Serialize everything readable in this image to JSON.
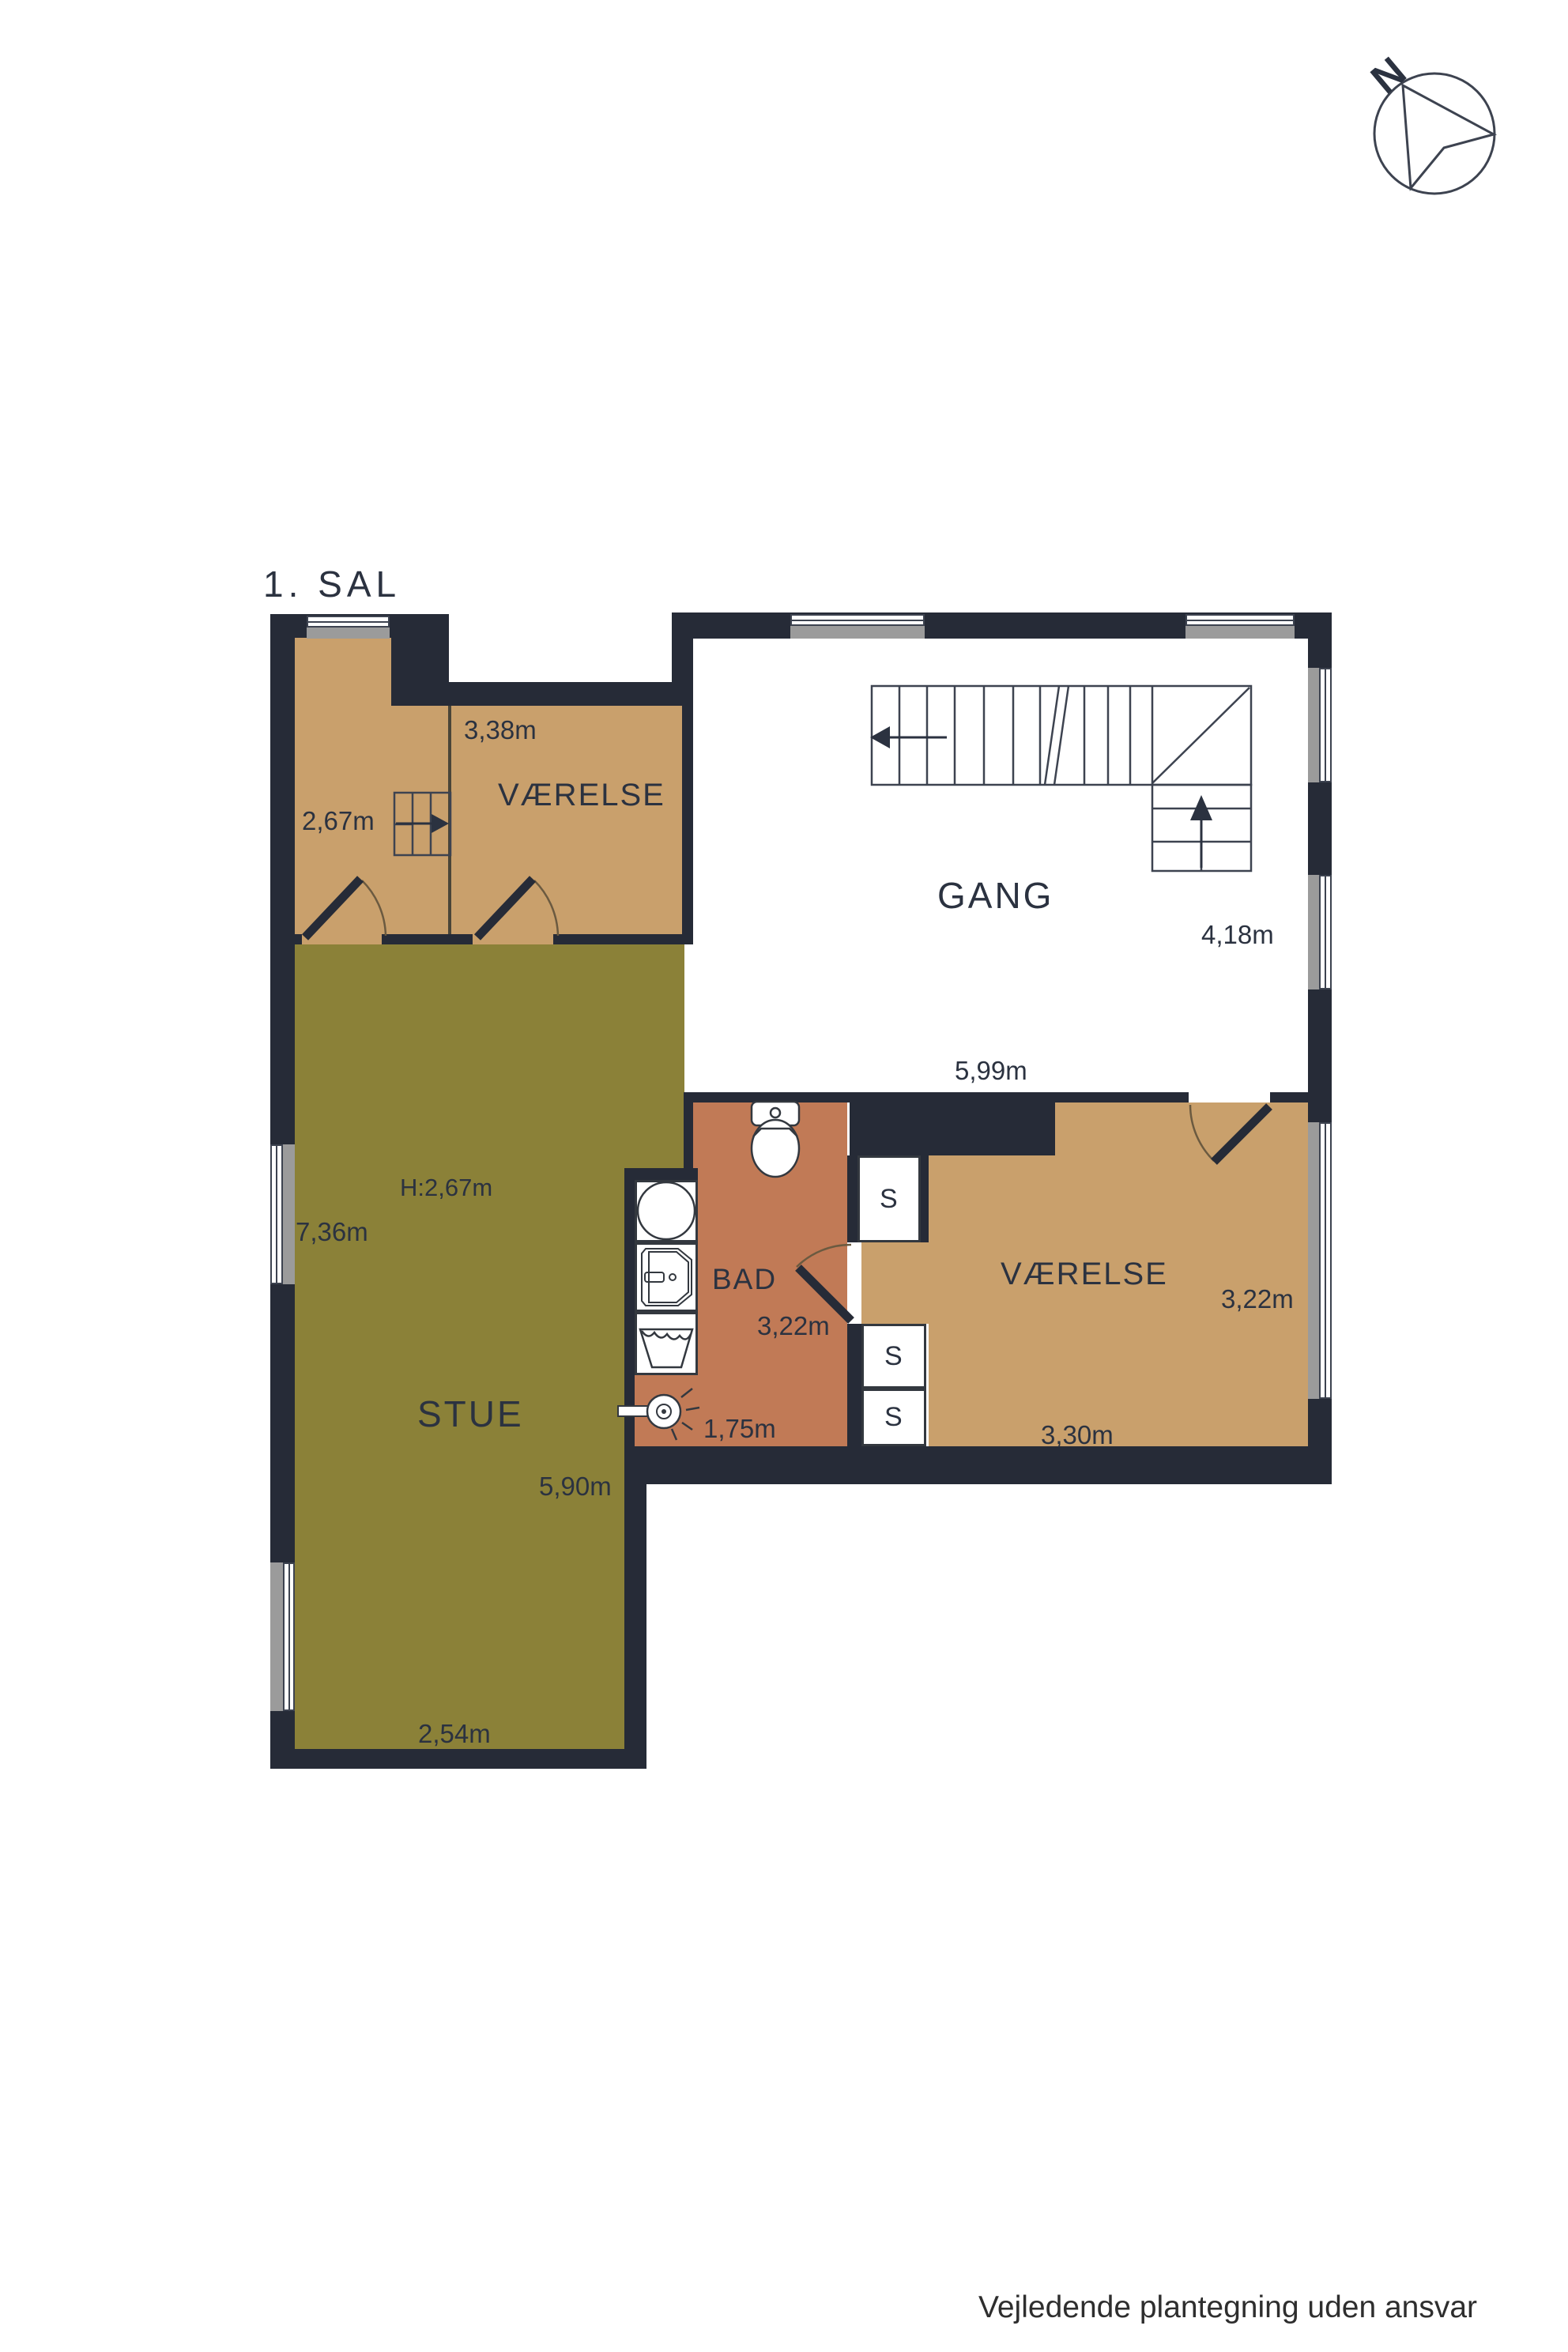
{
  "title": "1. SAL",
  "compass": {
    "label": "N"
  },
  "rooms": {
    "landing": {
      "width_label": "2,67m"
    },
    "vaerelse_top": {
      "name": "VÆRELSE",
      "width_label": "3,38m"
    },
    "gang": {
      "name": "GANG",
      "width_label": "5,99m",
      "depth_label": "4,18m"
    },
    "stue": {
      "name": "STUE",
      "ceiling_label": "H:2,67m",
      "depth_label": "7,36m",
      "width_label": "5,90m",
      "bottom_width_label": "2,54m"
    },
    "bad": {
      "name": "BAD",
      "width_label": "1,75m",
      "depth_label": "3,22m"
    },
    "vaerelse_bottom": {
      "name": "VÆRELSE",
      "width_label": "3,30m",
      "depth_label": "3,22m"
    },
    "closet_label": "S"
  },
  "footer": {
    "disclaimer": "Vejledende plantegning uden ansvar"
  },
  "colors": {
    "wall": "#262b37",
    "room_tan": "#c9a06c",
    "room_olive": "#8b8138",
    "room_bathroom": "#c17a56",
    "window_gray": "#9b9b9b"
  }
}
